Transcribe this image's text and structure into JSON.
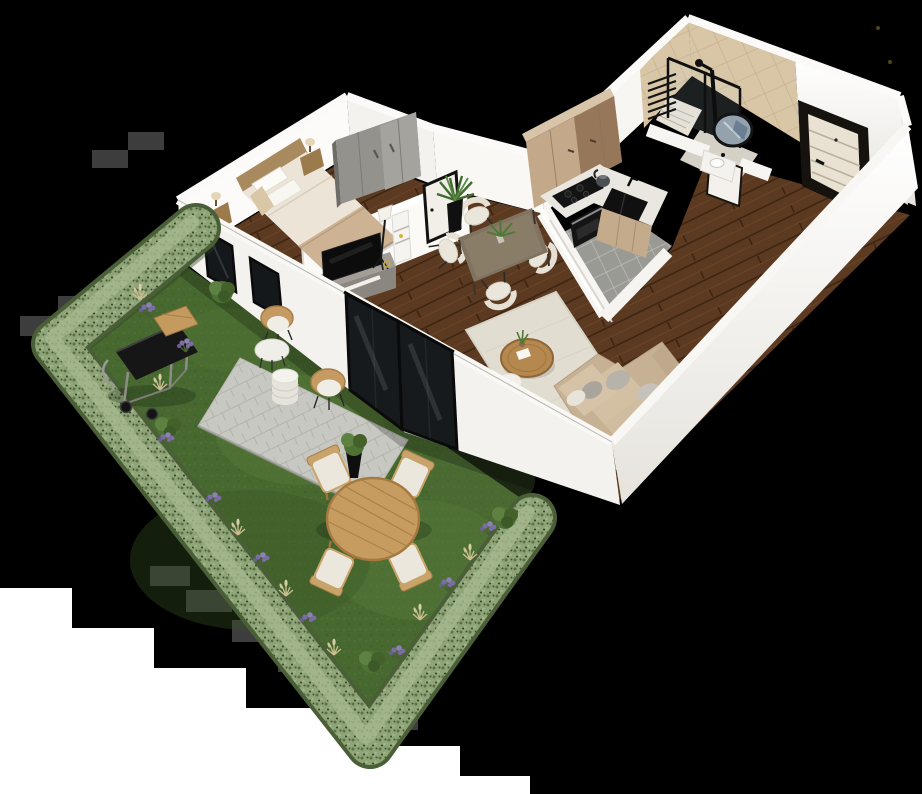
{
  "scene": {
    "label": "3D isometric floor plan render of a one-bedroom apartment with private garden",
    "background": "#000000"
  },
  "palette": {
    "wall": "#f6f4f1",
    "wall_shadow": "#e6e3dd",
    "wood_floor": "#5b3a21",
    "kitchen_tile": "#9a9a95",
    "bath_tile": "#d9c6a6",
    "grass": "#47682f",
    "hedge": "#8fa478",
    "paver": "#c8c8c3",
    "sofa": "#c7b194",
    "cabinet_beige": "#c3a98a",
    "cabinet_brown": "#97775a",
    "appliance_black": "#141414",
    "door_frame_dark": "#16120e",
    "door_leaf_cream": "#e9e2d2",
    "lavender": "#7b6da5",
    "garden_wood": "#c69c60"
  },
  "bedroom": {
    "label": "Bedroom",
    "bed": "Double bed with cream duvet",
    "headboard": "Wooden headboard",
    "nightstand_left": "Nightstand with lamp",
    "nightstand_right": "Nightstand with lamp",
    "wardrobe": "Grey wardrobe",
    "door": "Bedroom door",
    "window": "Garden-side window"
  },
  "living": {
    "label": "Living room",
    "sofa": "Beige L-shaped sofa with grey cushions",
    "rug": "Cream area rug",
    "coffee_table": "Round wooden coffee table",
    "side_table": "White side table",
    "tv": "Television",
    "tv_stand": "Grey TV stand",
    "floor_lamp": "Tripod floor lamp",
    "shelf": "White shelf tower",
    "patio_door": "Black-framed sliding glass door to garden"
  },
  "dining": {
    "label": "Dining area",
    "table": "Taupe dining table",
    "chairs": "Four cream dining chairs",
    "plant": "Tall black planter with palm"
  },
  "kitchen": {
    "label": "Kitchen",
    "cabinets": "Two-tone tall cabinets",
    "counter": "White stone countertop",
    "cooktop": "Black induction cooktop",
    "oven": "Built-in oven",
    "sink": "Black sink with tap",
    "kettle": "Kettle",
    "floor": "Grey tiled floor"
  },
  "bathroom": {
    "label": "Bathroom",
    "shower": "Walk-in shower with black-framed glass",
    "towel_radiator": "Ladder towel radiator",
    "mirror": "Round mirror",
    "vanity": "Washbasin vanity",
    "door": "Bathroom door"
  },
  "entry": {
    "label": "Entrance hall",
    "door": "Entrance door with dark frame"
  },
  "garden": {
    "label": "Garden",
    "hedge": "Clipped hedge border",
    "lawn": "Lawn",
    "patio": "Paved patio",
    "bbq": "Black barbecue grill with side shelf",
    "wicker_chairs": "Two rattan chairs with white cushions",
    "drum_table": "White drum side table",
    "round_table": "Round white patio table",
    "dining_table": "Round wooden garden table",
    "dining_chairs": "Four wooden garden chairs with cushions",
    "planter": "Black planter with shrub",
    "lavender": "Lavender plants",
    "bushes": "Green bushes",
    "grasses": "Ornamental grasses"
  }
}
